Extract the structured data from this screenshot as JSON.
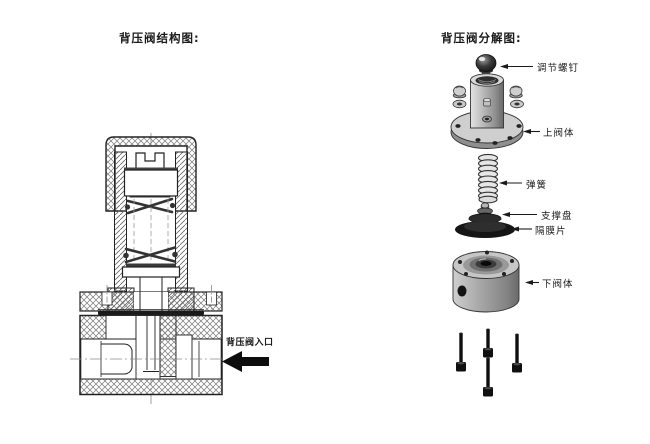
{
  "left_panel": {
    "title": "背压阀结构图:",
    "inlet_label": "背压阀入口"
  },
  "right_panel": {
    "title": "背压阀分解图:",
    "labels": [
      {
        "part": "adjusting-screw",
        "text": "调节螺钉"
      },
      {
        "part": "upper-valve-body",
        "text": "上阀体"
      },
      {
        "part": "spring",
        "text": "弹簧"
      },
      {
        "part": "support-plate",
        "text": "支撑盘"
      },
      {
        "part": "diaphragm",
        "text": "隔膜片"
      },
      {
        "part": "lower-valve-body",
        "text": "下阀体"
      }
    ]
  },
  "colors": {
    "background": "#ffffff",
    "line": "#222222",
    "metal_light": "#d9d9d9",
    "metal_mid": "#9a9a9a",
    "metal_dark": "#555555",
    "dark_part": "#151515"
  }
}
